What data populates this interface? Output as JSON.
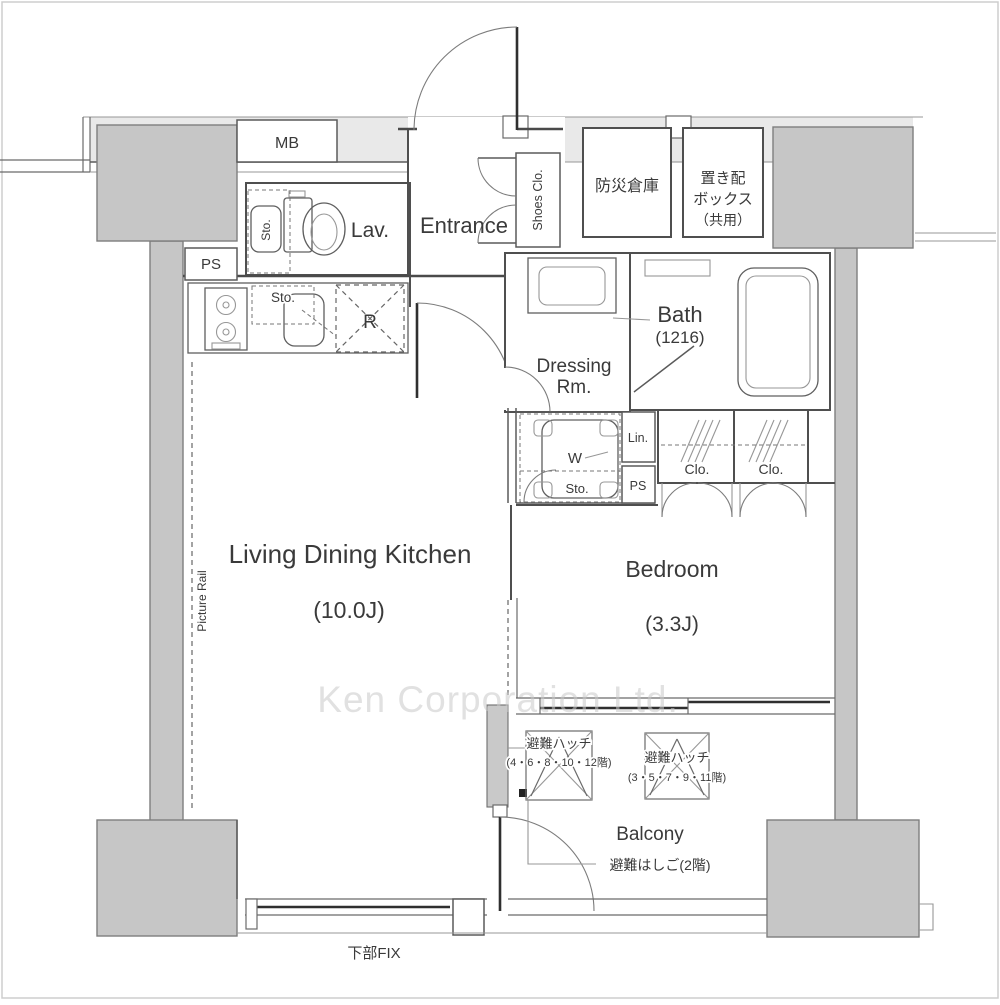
{
  "page": {
    "watermark": "Ken Corporation Ltd."
  },
  "common": {
    "mb": "MB",
    "ps_upper": "PS",
    "disaster_storage": "防災倉庫",
    "delivery_box": [
      "置き配",
      "ボックス",
      "（共用）"
    ]
  },
  "entrance": {
    "label": "Entrance",
    "shoes_closet": "Shoes Clo."
  },
  "lavatory": {
    "label": "Lav.",
    "storage": "Sto."
  },
  "kitchen": {
    "storage": "Sto.",
    "refrigerator": "R"
  },
  "ldk": {
    "name": "Living Dining Kitchen",
    "size": "(10.0J)",
    "picture_rail": "Picture Rail"
  },
  "bedroom": {
    "name": "Bedroom",
    "size": "(3.3J)"
  },
  "dressing": {
    "line1": "Dressing",
    "line2": "Rm."
  },
  "bath": {
    "name": "Bath",
    "size": "(1216)"
  },
  "utility": {
    "washer": "W",
    "storage": "Sto.",
    "linen": "Lin.",
    "ps": "PS",
    "closet_left": "Clo.",
    "closet_right": "Clo."
  },
  "balcony": {
    "label": "Balcony",
    "hatch_a": {
      "line1": "避難ハッチ",
      "line2": "(4・6・8・10・12階)"
    },
    "hatch_b": {
      "line1": "避難ハッチ",
      "line2": "(3・5・7・9・11階)"
    },
    "escape_ladder": "避難はしご(2階)"
  },
  "window": {
    "fix_label": "下部FIX"
  }
}
